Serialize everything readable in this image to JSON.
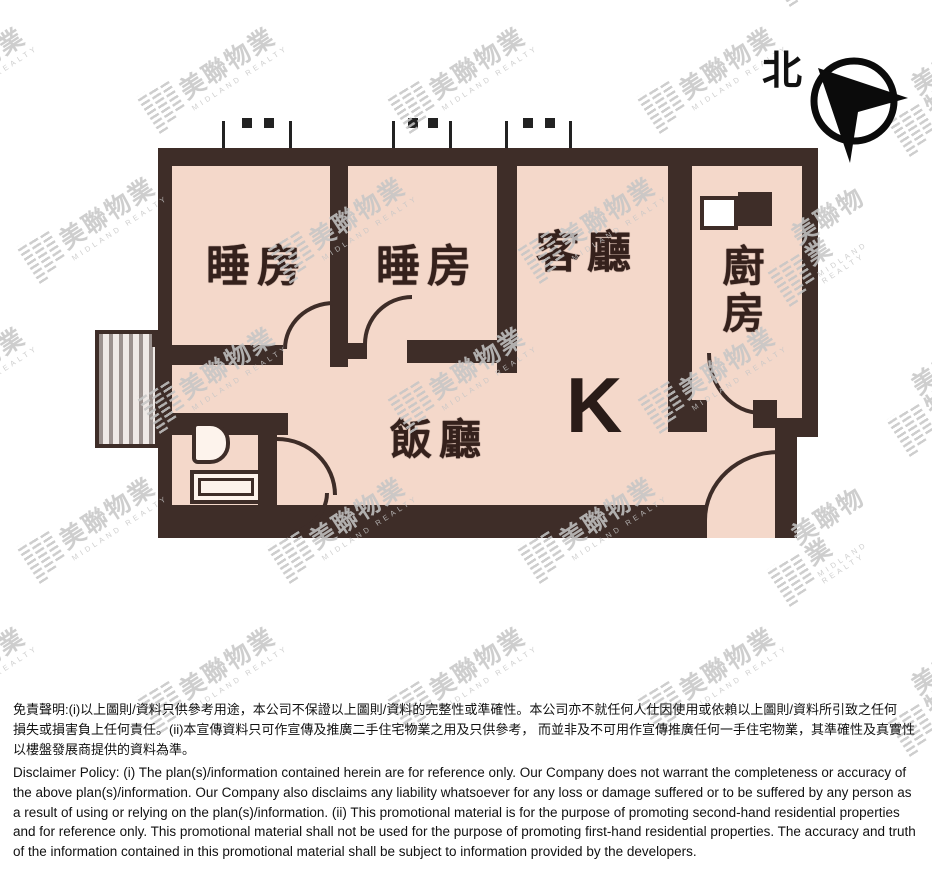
{
  "north": {
    "label": "北"
  },
  "watermark": {
    "text": "美聯物業",
    "subtext": "MIDLAND REALTY"
  },
  "plan": {
    "unit_label": "K",
    "rooms": {
      "bedroom1": "睡房",
      "bedroom2": "睡房",
      "living": "客廳",
      "kitchen": "廚房",
      "dining": "飯廳"
    }
  },
  "colors": {
    "wall": "#3e2d28",
    "floor": "#f4d8ca",
    "watermark": "#c6c6c6"
  },
  "disclaimer": {
    "chinese_lines": [
      "免責聲明:(i)以上圖則/資料只供參考用途，本公司不保證以上圖則/資料的完整性或準確性。本公司亦不就任何人仕因使用或依賴以上圖則/資料所引致之任何",
      "損失或損害負上任何責任。(ii)本宣傳資料只可作宣傳及推廣二手住宅物業之用及只供參考， 而並非及不可用作宣傳推廣任何一手住宅物業，其準確性及真實性",
      "以樓盤發展商提供的資料為準。"
    ],
    "english": "Disclaimer Policy: (i) The plan(s)/information contained herein are for reference only. Our Company does not warrant the completeness or accuracy of the above plan(s)/information. Our Company also disclaims any liability whatsoever for any loss or damage suffered or to be suffered by any person as a result of using or relying on the plan(s)/information. (ii) This promotional material is for the purpose of promoting second-hand residential properties and for reference only. This promotional material shall not be used for the purpose of promoting first-hand residential properties. The accuracy and truth of the information contained in this promotional material shall be subject to information provided by the developers."
  }
}
